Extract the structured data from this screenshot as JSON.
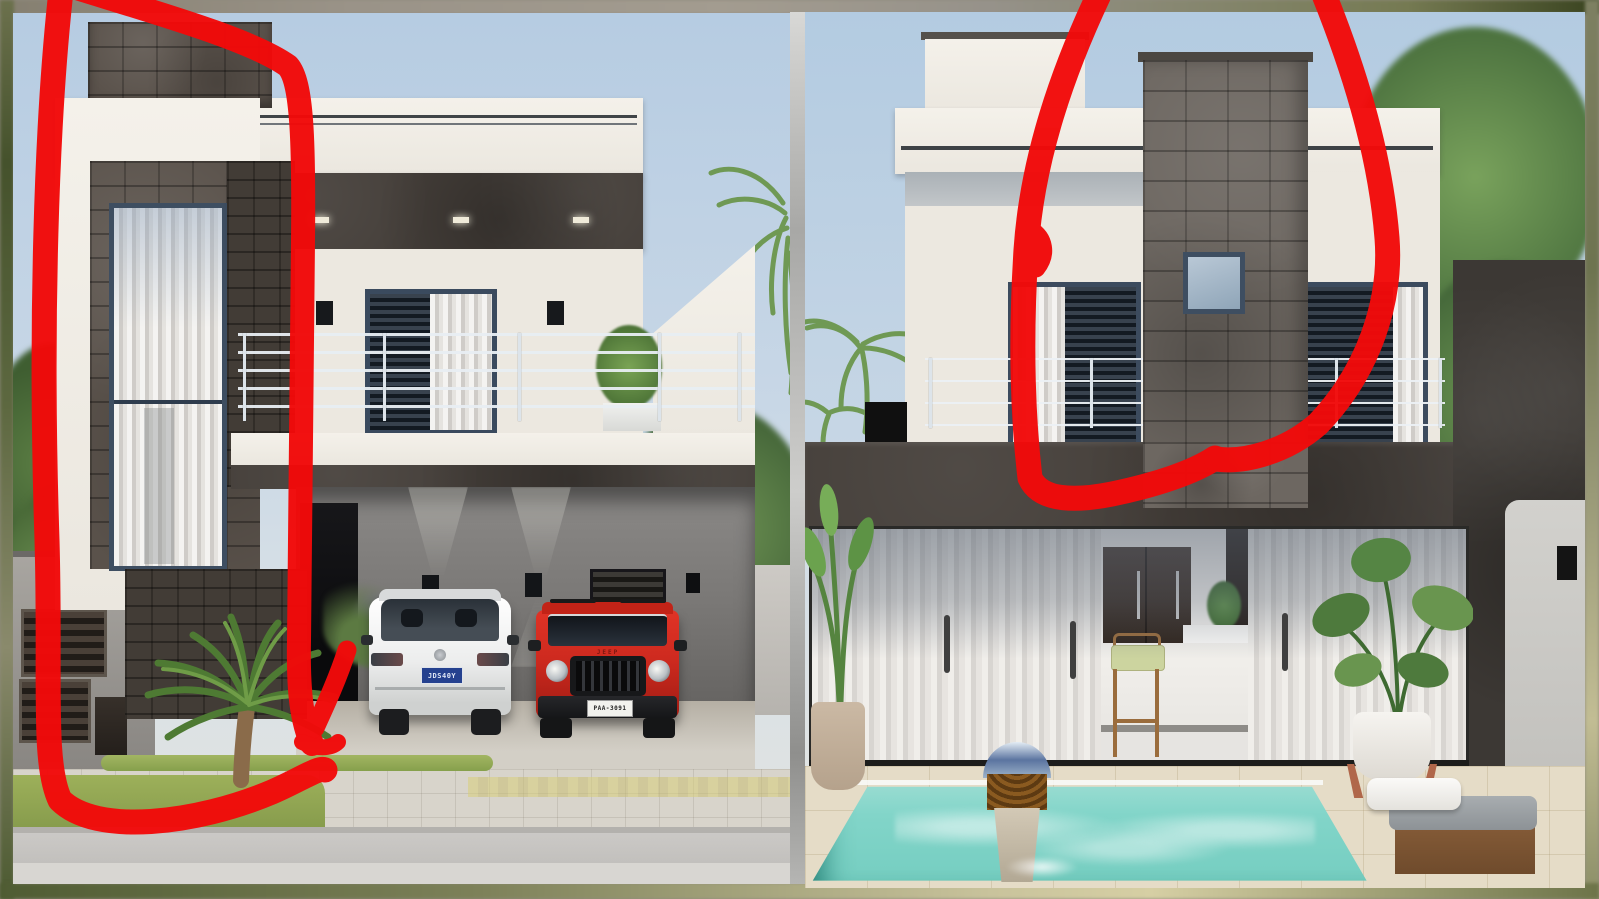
{
  "canvas": {
    "width": 1599,
    "height": 899
  },
  "scene": {
    "type": "architectural-render-comparison",
    "panels": [
      "front-facade-day-render",
      "rear-facade-pool-render"
    ]
  },
  "annotation": {
    "tool": "red-marker-freehand",
    "color": "#f20a0a",
    "left_marks": {
      "loop_left_bottom": "M 62,-18 C 46,120 40,330 47,540 C 51,680 42,762 60,800 C 96,836 196,824 272,792 C 300,780 320,766 325,770",
      "loop_top_right": "M 70,-14 C 160,14 252,40 288,66 C 302,82 304,140 303,240 L 299,640 C 298,692 302,722 312,744",
      "arrow_flare": "M 347,650 C 338,678 326,704 315,728",
      "arrow_foot": "M 302,742 C 316,749 331,749 338,742"
    },
    "right_marks": {
      "loop_left_bottom": "M 1106,-20 C 1062,70 1032,160 1026,250 C 1021,330 1022,410 1030,478 C 1040,500 1072,502 1112,494 C 1156,485 1194,472 1215,458",
      "jitter_bump": "M 1030,230 C 1044,238 1047,254 1036,268",
      "loop_right": "M 1318,-20 C 1352,62 1380,150 1387,238 C 1392,302 1368,372 1318,424 C 1286,452 1244,463 1216,459"
    }
  },
  "left_panel": {
    "label": "front elevation with carport",
    "vehicles": {
      "white_car": {
        "body_color": "#f2f2f0",
        "plate": "JDS40Y",
        "plate_colors": {
          "bg": "#25418f",
          "text": "#dfe6f5"
        }
      },
      "red_jeep": {
        "body_color": "#ce2a1f",
        "badge": "JEEP",
        "plate": "PAA-3091",
        "plate_colors": {
          "bg": "#f2f2ee",
          "text": "#222222"
        }
      }
    },
    "palette": {
      "sky": "#b6cce2",
      "facade_white": "#f3f0ea",
      "dark_cladding": "#453f3a",
      "stone_column": "#5a524b",
      "railing": "#dde4ea",
      "grass": "#93a855",
      "lavender": "#8f74b4"
    }
  },
  "right_panel": {
    "label": "rear elevation with pool",
    "palette": {
      "sky": "#b3cbe1",
      "facade_white": "#efebe3",
      "chimney_stone": "#6d6761",
      "dark_band": "#453f39",
      "pool_water": "#82d5c9",
      "deck": "#e5dcc7",
      "curtain": "#e9e6e2",
      "stool_cushion": "#ccd49f"
    }
  },
  "frame": {
    "style": "blurred-olive-tan-border",
    "divider": "#c9c9c7"
  }
}
